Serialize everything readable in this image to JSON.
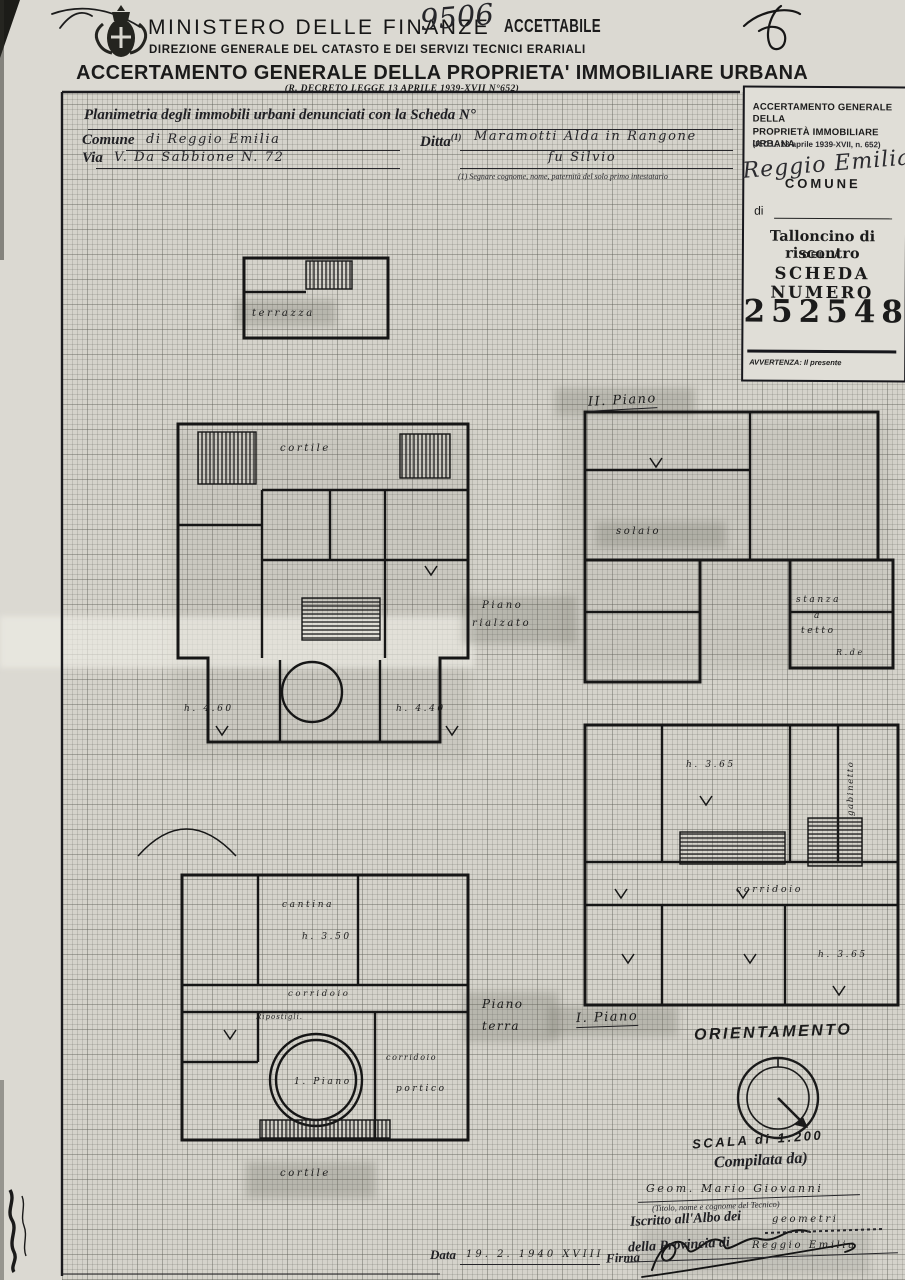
{
  "header": {
    "ministry": "MINISTERO DELLE FINANZE",
    "number_hw": "9506",
    "stamp": "ACCETTABILE",
    "direction": "DIREZIONE GENERALE DEL CATASTO E DEI SERVIZI TECNICI ERARIALI",
    "title": "ACCERTAMENTO GENERALE DELLA PROPRIETA' IMMOBILIARE URBANA",
    "law": "(R. DECRETO LEGGE 13 APRILE 1939-XVII N°652)"
  },
  "form": {
    "planimetria_label": "Planimetria degli immobili urbani denunciati con la Scheda N°",
    "comune_label": "Comune",
    "comune_value": "di Reggio Emilia",
    "ditta_label": "Ditta",
    "ditta_ref": "(1)",
    "ditta_value": "Maramotti Alda in Rangone",
    "ditta_value2": "fu Silvio",
    "via_label": "Via",
    "via_value": "V. Da Sabbione N. 72",
    "footnote": "(1) Segnare cognome, nome, paternità del solo primo intestatario"
  },
  "talloncino": {
    "title1": "ACCERTAMENTO GENERALE DELLA",
    "title2": "PROPRIETÀ IMMOBILIARE URBANA",
    "law": "(R.D.L. 13 aprile 1939-XVII, n. 652)",
    "comune": "COMUNE",
    "comune_hw": "Reggio Emilia",
    "di": "di",
    "riscontro": "Talloncino di riscontro",
    "della": "DELLA",
    "scheda": "SCHEDA NUMERO",
    "numero": "2525482",
    "avvertenza": "AVVERTENZA: Il presente"
  },
  "plan_labels": {
    "terrazza": "terrazza",
    "cortile_upper": "cortile",
    "cortile_lower": "cortile",
    "piano2": "II. Piano",
    "solaio": "solaio",
    "piano_rialzato_1": "Piano",
    "piano_rialzato_2": "rialzato",
    "stanza": "stanza",
    "a": "a",
    "tetto": "tetto",
    "rde": "R.de",
    "h_460": "h. 4.60",
    "h_440": "h. 4.40",
    "cantina": "cantina",
    "h_350": "h. 3.50",
    "corridoio_1": "corridoio",
    "ripostigli": "Ripostigli.",
    "corridoio_2": "corridoio",
    "corridoio_3": "corridoio",
    "circle_room": "1. Piano",
    "portico": "portico",
    "gabinetto": "gabinetto",
    "h_365a": "h. 3.65",
    "h_365b": "h. 3.65",
    "piano_terra_1": "Piano",
    "piano_terra_2": "terra",
    "piano1": "I. Piano"
  },
  "footer": {
    "orientamento": "ORIENTAMENTO",
    "scala": "SCALA di 1:200",
    "compilata": "Compilata da)",
    "tecnico_hw": "Geom. Mario Giovanni",
    "tecnico_note": "(Titolo, nome e cognome del Tecnico)",
    "albo_label": "Iscritto all'Albo dei",
    "albo_hw": "geometri",
    "provincia_label": "della Provincia di",
    "provincia_hw": "Reggio Emilia",
    "data_label": "Data",
    "data_hw": "19. 2. 1940 XVIII",
    "firma_label": "Firma"
  }
}
